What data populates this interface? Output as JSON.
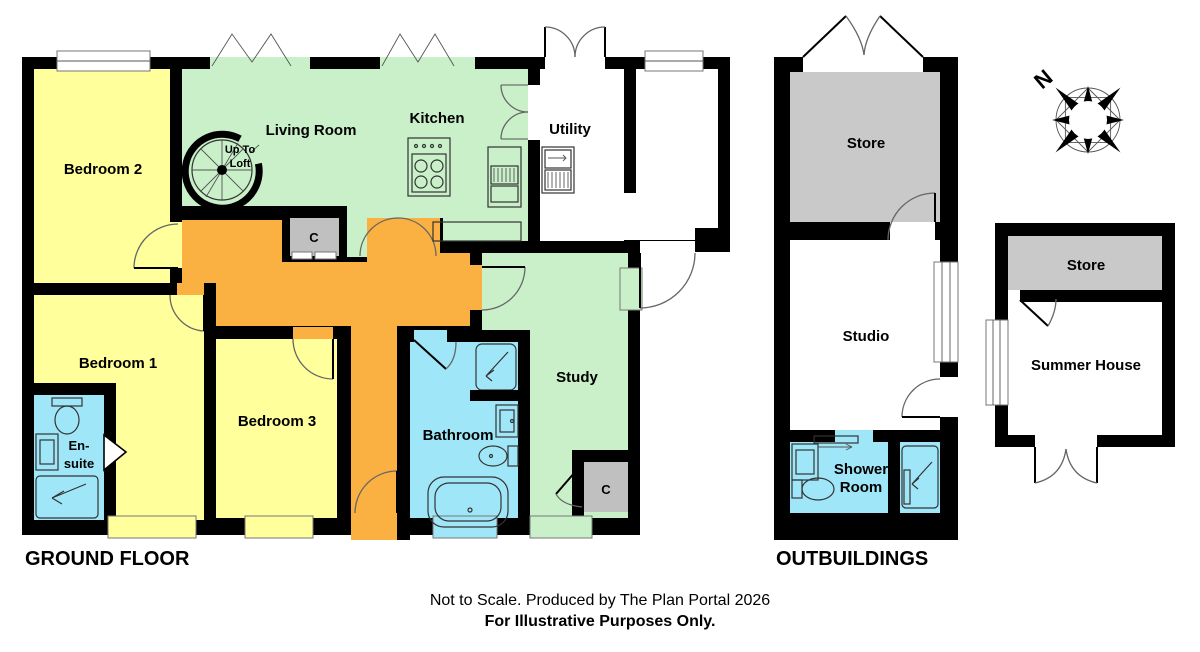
{
  "palette": {
    "wall": "#000000",
    "room_yellow": "#FFFF9C",
    "room_green": "#C9F0C9",
    "hall_orange": "#FBB042",
    "bath_cyan": "#9FE7F8",
    "shower_cyan_light": "#C8F2FB",
    "store_gray": "#C9C9C9",
    "closet_gray": "#C0C0C0"
  },
  "ground_floor": {
    "title": "GROUND FLOOR",
    "rooms": {
      "bedroom2": "Bedroom 2",
      "bedroom1": "Bedroom 1",
      "bedroom3": "Bedroom 3",
      "living_room": "Living Room",
      "kitchen": "Kitchen",
      "utility": "Utility",
      "study": "Study",
      "bathroom": "Bathroom",
      "ensuite_line1": "En-",
      "ensuite_line2": "suite",
      "closet": "C",
      "stairs_line1": "Up To",
      "stairs_line2": "Loft"
    }
  },
  "outbuildings": {
    "title": "OUTBUILDINGS",
    "rooms": {
      "store": "Store",
      "studio": "Studio",
      "shower_line1": "Shower",
      "shower_line2": "Room"
    }
  },
  "summer_house": {
    "rooms": {
      "store": "Store",
      "summer_house": "Summer House"
    }
  },
  "compass": {
    "north": "N"
  },
  "footer": {
    "line1": "Not to Scale. Produced by The Plan Portal 2026",
    "line2": "For Illustrative Purposes Only."
  }
}
